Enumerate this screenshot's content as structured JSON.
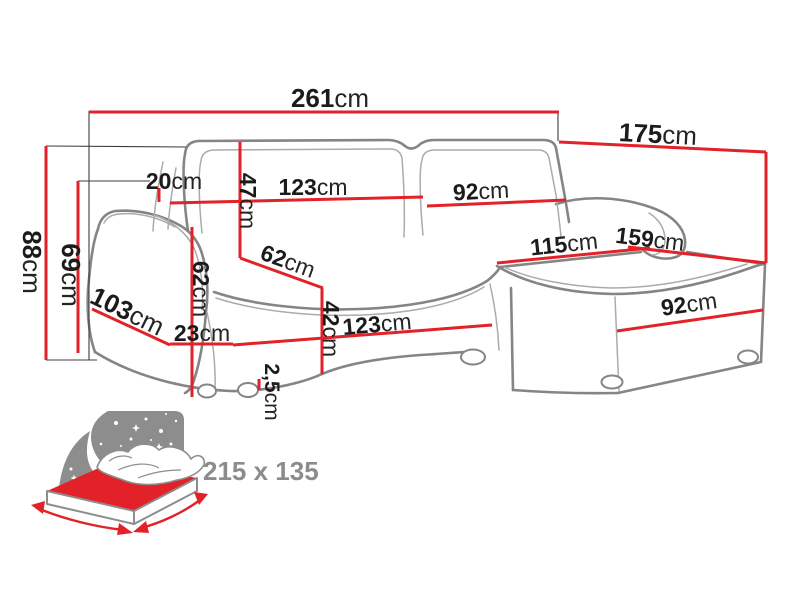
{
  "colors": {
    "dimension_red": "#e32128",
    "outline_gray": "#858585",
    "projection_black": "#3d3d3d",
    "text_black": "#1b1b1b",
    "icon_gray": "#8d8d8d",
    "sleeping_text_gray": "#8c8c8c"
  },
  "dimensions": {
    "total_width": {
      "value": "261",
      "unit": "cm"
    },
    "total_depth": {
      "value": "175",
      "unit": "cm"
    },
    "total_height": {
      "value": "88",
      "unit": "cm"
    },
    "armrest_height": {
      "value": "69",
      "unit": "cm"
    },
    "armrest_top_width": {
      "value": "20",
      "unit": "cm"
    },
    "backrest_height": {
      "value": "47",
      "unit": "cm"
    },
    "seat_width_top": {
      "value": "123",
      "unit": "cm"
    },
    "back_cushion_right_width": {
      "value": "92",
      "unit": "cm"
    },
    "armrest_front_height": {
      "value": "62",
      "unit": "cm"
    },
    "seat_depth": {
      "value": "62",
      "unit": "cm"
    },
    "side_depth": {
      "value": "103",
      "unit": "cm"
    },
    "armrest_bottom_width": {
      "value": "23",
      "unit": "cm"
    },
    "seat_height": {
      "value": "42",
      "unit": "cm"
    },
    "seat_width_front": {
      "value": "123",
      "unit": "cm"
    },
    "leg_height": {
      "value": "2,5",
      "unit": "cm"
    },
    "chaise_inner_length": {
      "value": "115",
      "unit": "cm"
    },
    "chaise_length": {
      "value": "159",
      "unit": "cm"
    },
    "chaise_front_width": {
      "value": "92",
      "unit": "cm"
    }
  },
  "sleeping_area": {
    "label": "215 x 135"
  }
}
